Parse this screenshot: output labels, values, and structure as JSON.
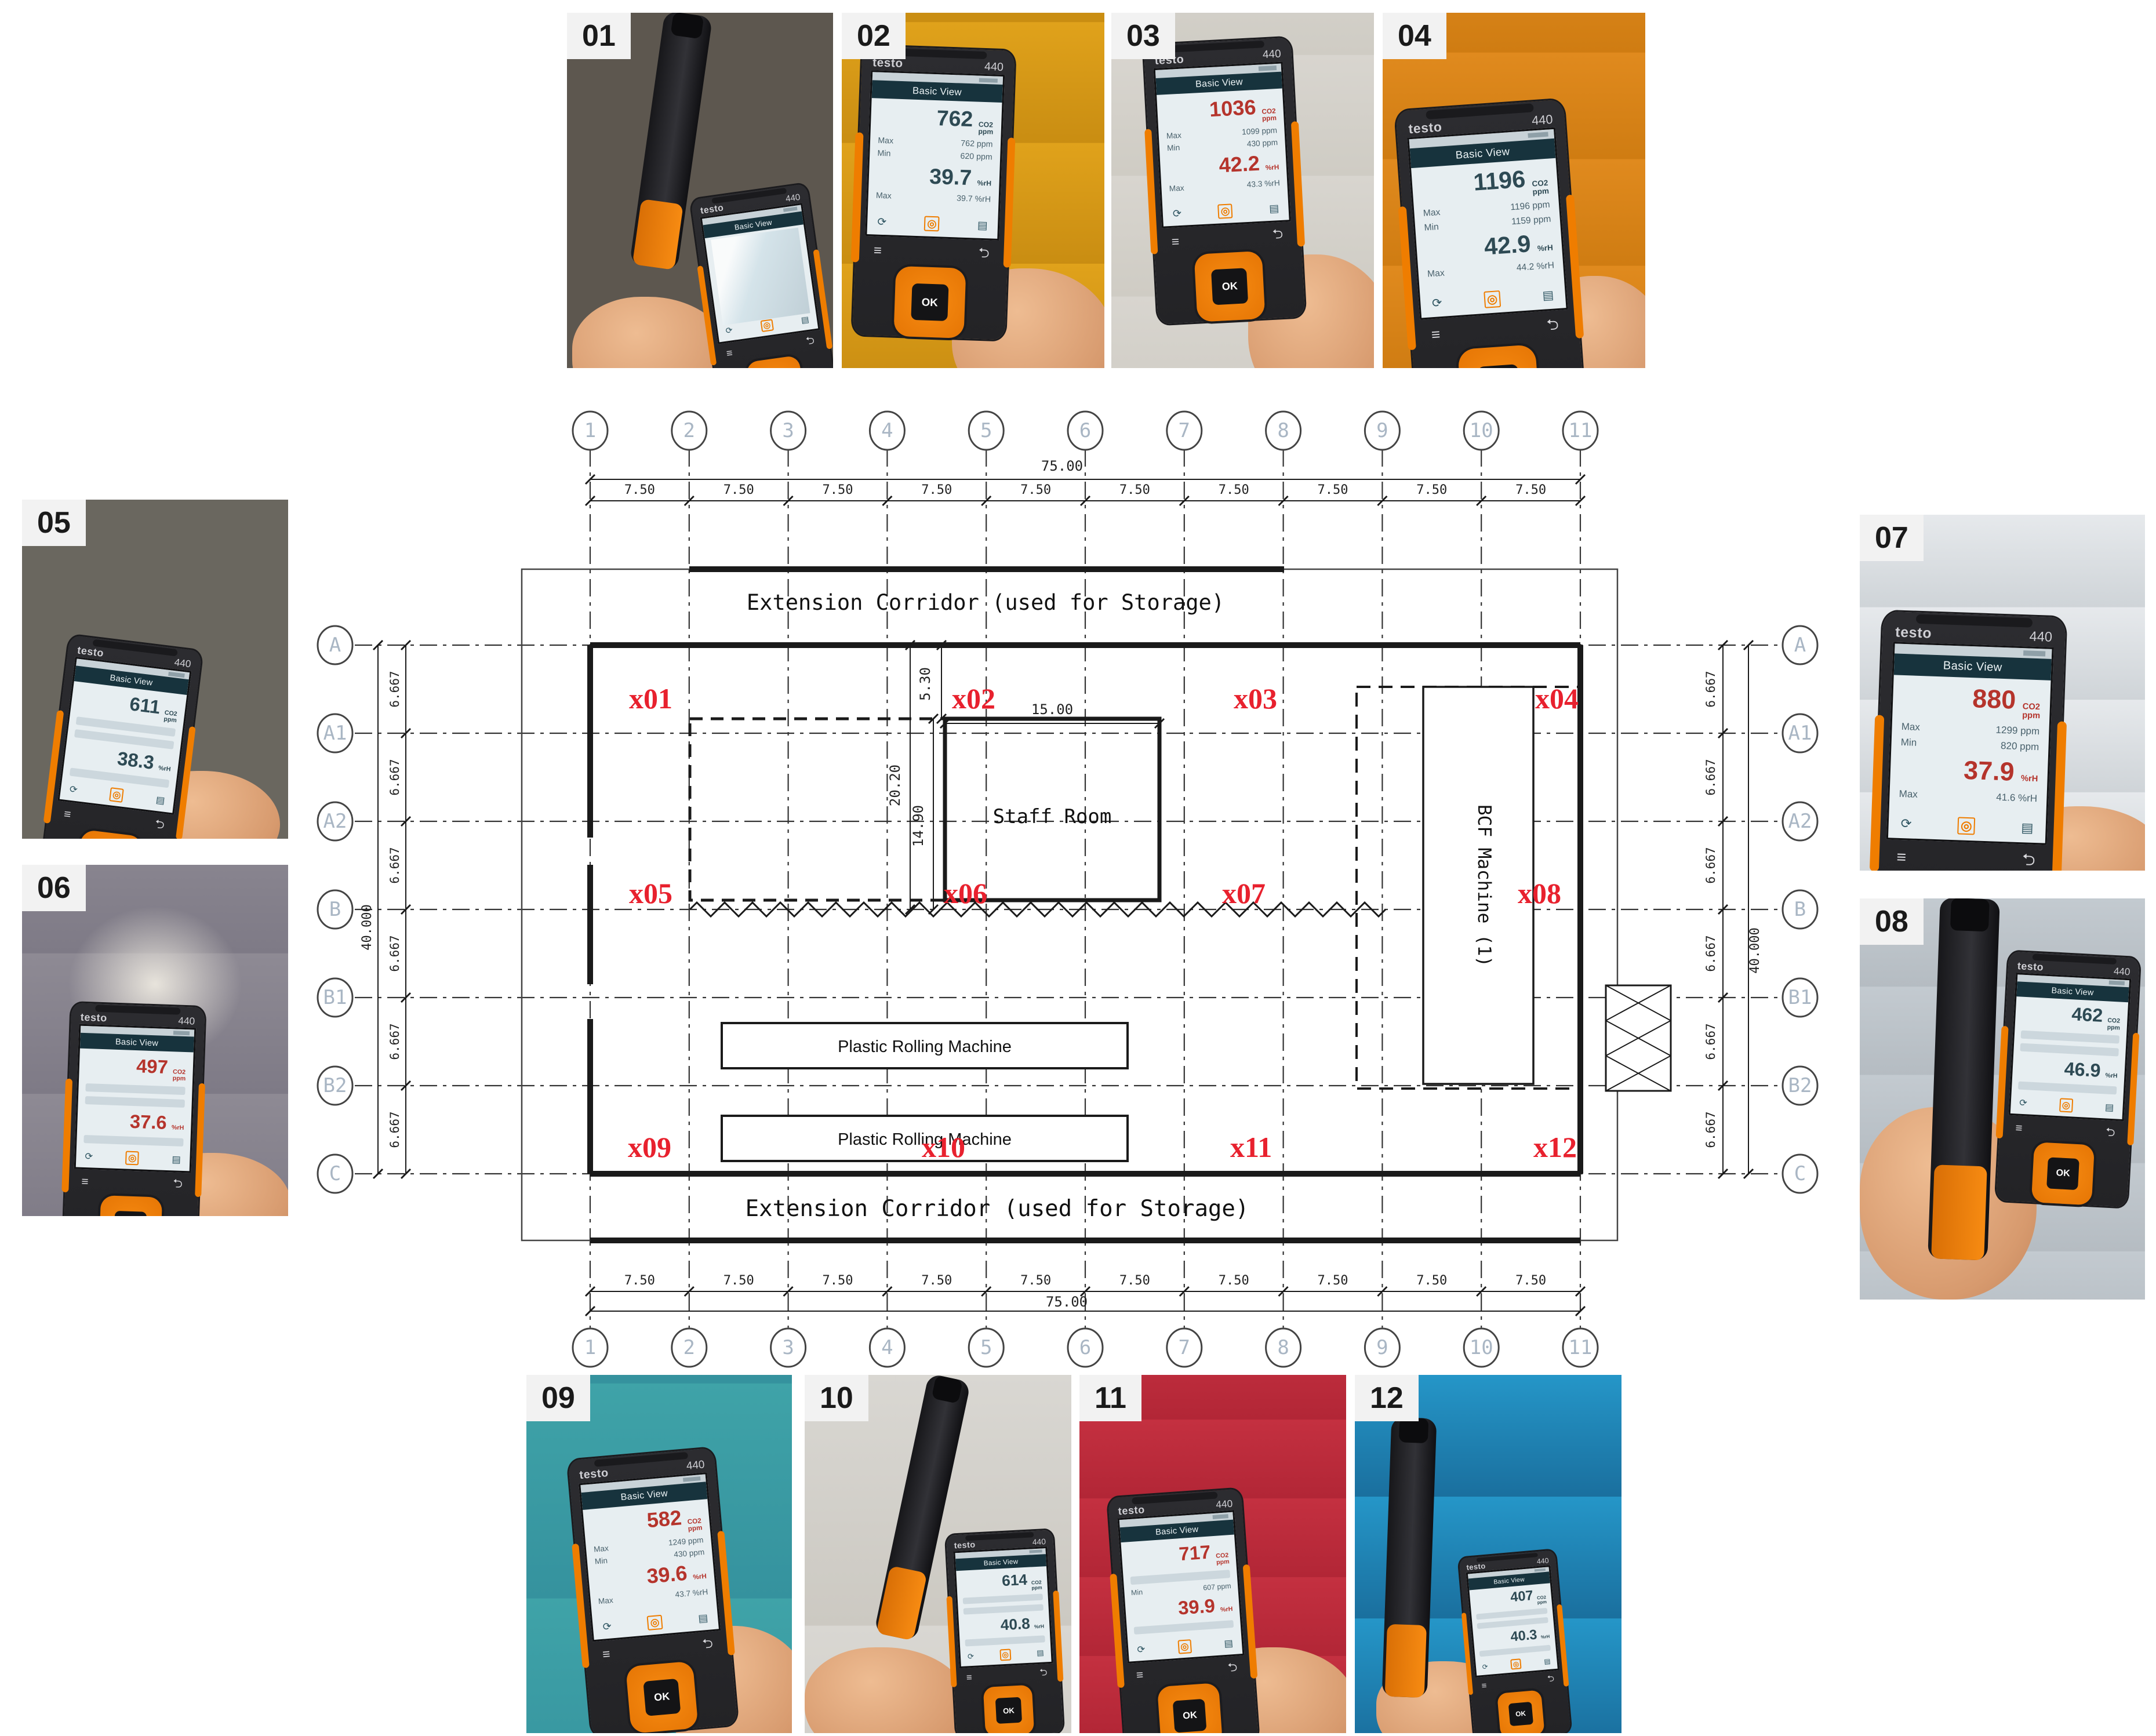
{
  "colors": {
    "accent_orange": "#ef7d00",
    "point_label_red": "#e8212e",
    "screen_value_dark": "#2e4a54",
    "screen_value_red": "#b5342c"
  },
  "plan": {
    "grid": {
      "columns": [
        "1",
        "2",
        "3",
        "4",
        "5",
        "6",
        "7",
        "8",
        "9",
        "10",
        "11"
      ],
      "rows": [
        "A",
        "A1",
        "A2",
        "B",
        "B1",
        "B2",
        "C"
      ],
      "col_spacing_label": "7.50",
      "col_total_label": "75.00",
      "row_spacing_label": "6.667",
      "row_total_label": "40.000"
    },
    "texts": {
      "corridor_top": "Extension Corridor (used for Storage)",
      "corridor_bottom": "Extension Corridor (used for Storage)",
      "staff_room": "Staff Room",
      "bcf_machine": "BCF Machine (1)",
      "rolling_machine_1": "Plastic Rolling Machine",
      "rolling_machine_2": "Plastic Rolling Machine",
      "dim_staff_width": "15.00",
      "dim_offset_top": "5.30",
      "dim_hall_depth": "20.20",
      "dim_staff_depth": "14.90"
    },
    "points": [
      "x01",
      "x02",
      "x03",
      "x04",
      "x05",
      "x06",
      "x07",
      "x08",
      "x09",
      "x10",
      "x11",
      "x12"
    ]
  },
  "device": {
    "brand": "testo",
    "model": "440",
    "screen_title": "Basic View",
    "max_label": "Max",
    "min_label": "Min",
    "ok_label": "OK",
    "menu_icon": "≡",
    "back_icon": "⮌",
    "cycle_icon": "⟳",
    "target_icon": "◎",
    "save_icon": "▤"
  },
  "photos": [
    {
      "id": "01",
      "screen": null
    },
    {
      "id": "02",
      "screen": {
        "co2": "762",
        "co2_unit": "CO2 ppm",
        "max": "762 ppm",
        "min": "620 ppm",
        "rh": "39.7",
        "rh_unit": "%rH",
        "rh_max": "39.7 %rH",
        "value_color": "#2e4a54"
      }
    },
    {
      "id": "03",
      "screen": {
        "co2": "1036",
        "co2_unit": "CO2 ppm",
        "max": "1099 ppm",
        "min": "430 ppm",
        "rh": "42.2",
        "rh_unit": "%rH",
        "rh_max": "43.3 %rH",
        "value_color": "#b5342c"
      }
    },
    {
      "id": "04",
      "screen": {
        "co2": "1196",
        "co2_unit": "CO2 ppm",
        "max": "1196 ppm",
        "min": "1159 ppm",
        "rh": "42.9",
        "rh_unit": "%rH",
        "rh_max": "44.2 %rH",
        "value_color": "#2e4a54"
      }
    },
    {
      "id": "05",
      "screen": {
        "co2": "611",
        "co2_unit": "CO2 ppm",
        "max": "",
        "min": "",
        "rh": "38.3",
        "rh_unit": "%rH",
        "rh_max": "",
        "value_color": "#2e4a54"
      }
    },
    {
      "id": "06",
      "screen": {
        "co2": "497",
        "co2_unit": "CO2 ppm",
        "max": "",
        "min": "",
        "rh": "37.6",
        "rh_unit": "%rH",
        "rh_max": "",
        "value_color": "#b5342c"
      }
    },
    {
      "id": "07",
      "screen": {
        "co2": "880",
        "co2_unit": "CO2 ppm",
        "max": "1299 ppm",
        "min": "820 ppm",
        "rh": "37.9",
        "rh_unit": "%rH",
        "rh_max": "41.6 %rH",
        "value_color": "#b5342c"
      }
    },
    {
      "id": "08",
      "screen": {
        "co2": "462",
        "co2_unit": "CO2 ppm",
        "max": "",
        "min": "",
        "rh": "46.9",
        "rh_unit": "%rH",
        "rh_max": "",
        "value_color": "#2e4a54"
      }
    },
    {
      "id": "09",
      "screen": {
        "co2": "582",
        "co2_unit": "CO2 ppm",
        "max": "1249 ppm",
        "min": "430 ppm",
        "rh": "39.6",
        "rh_unit": "%rH",
        "rh_max": "43.7 %rH",
        "value_color": "#b5342c"
      }
    },
    {
      "id": "10",
      "screen": {
        "co2": "614",
        "co2_unit": "CO2 ppm",
        "max": "",
        "min": "",
        "rh": "40.8",
        "rh_unit": "%rH",
        "rh_max": "",
        "value_color": "#2e4a54"
      }
    },
    {
      "id": "11",
      "screen": {
        "co2": "717",
        "co2_unit": "CO2 ppm",
        "max": "",
        "min": "607 ppm",
        "rh": "39.9",
        "rh_unit": "%rH",
        "rh_max": "",
        "value_color": "#b5342c"
      }
    },
    {
      "id": "12",
      "screen": {
        "co2": "407",
        "co2_unit": "CO2 ppm",
        "max": "",
        "min": "",
        "rh": "40.3",
        "rh_unit": "%rH",
        "rh_max": "",
        "value_color": "#2e4a54"
      }
    }
  ]
}
